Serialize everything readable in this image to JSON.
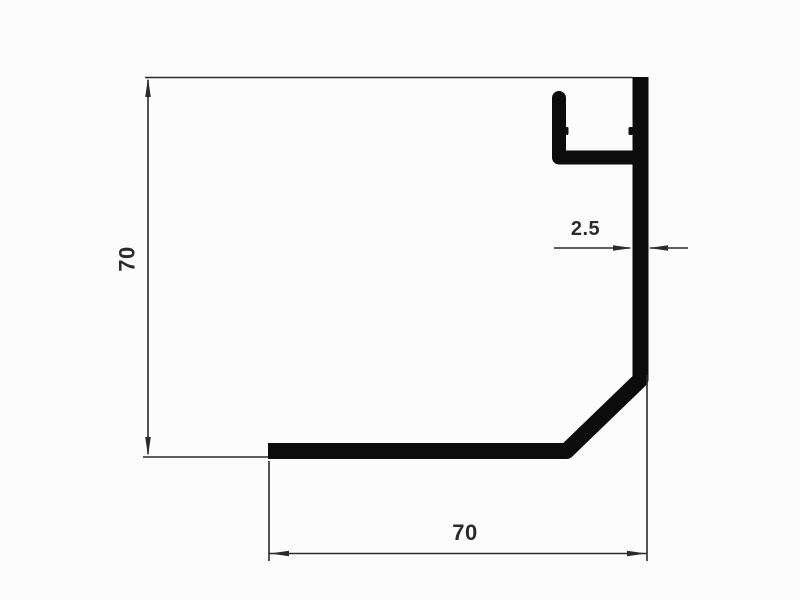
{
  "drawing": {
    "dimensions": {
      "height": "70",
      "width": "70",
      "wall_thickness": "2.5"
    },
    "colors": {
      "profile-color": "#0c0c0c",
      "dim-color": "#2a2a2a",
      "paper-color": "#fcfcfc"
    }
  }
}
